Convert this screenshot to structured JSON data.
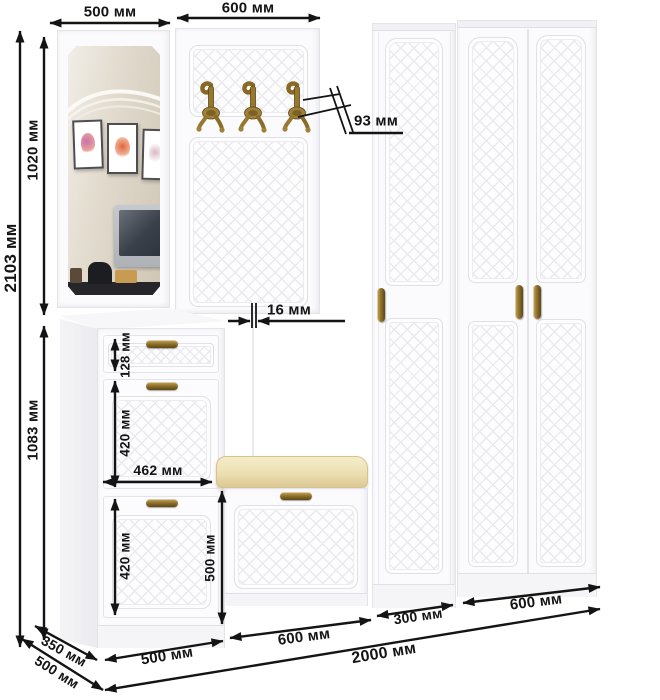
{
  "diagram": {
    "kind": "hallway furniture set dimension diagram",
    "units": "мм"
  },
  "dims": {
    "top_section_1": "500 мм",
    "top_section_2": "600 мм",
    "total_height": "2103 мм",
    "upper_section_height": "1020 мм",
    "lower_section_height": "1083 мм",
    "hook_offset": "93 мм",
    "panel_thickness": "16 мм",
    "drawer_front_height": "128 мм",
    "upper_flap_height": "420 мм",
    "inner_width": "462 мм",
    "lower_flap_height": "420 мм",
    "bench_section_height": "500 мм",
    "base_left_cabinet": "500 мм",
    "base_bench": "600 мм",
    "base_narrow_wardrobe": "300 мм",
    "base_wardrobe": "600 мм",
    "base_total": "2000 мм",
    "depth_upper": "350 мм",
    "depth_lower": "500 мм"
  },
  "colors": {
    "dimension_ink": "#141414",
    "furniture_white": "#fbfbfd",
    "panel_groove": "#e9e9ef",
    "brass": "#8a6b28",
    "cushion": "#ecdfb2"
  },
  "icons": {
    "coat_hook": "double brass coat hook",
    "drawer_handle": "brass bow handle",
    "door_handle": "brass vertical bow handle"
  }
}
